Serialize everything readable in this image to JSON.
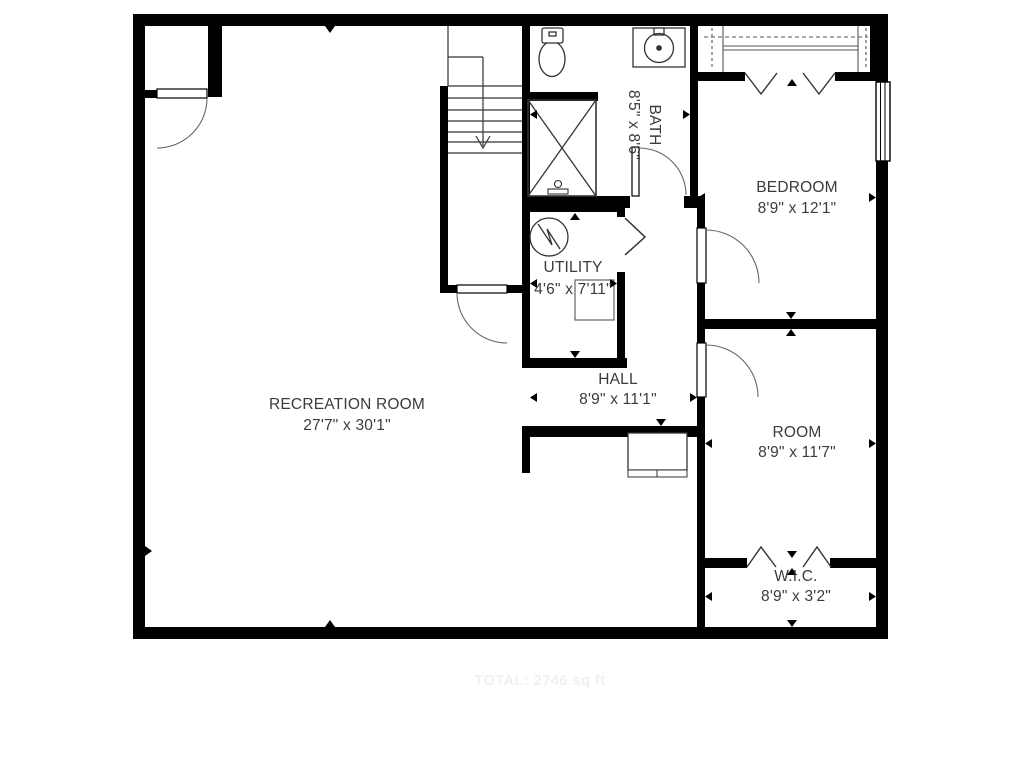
{
  "title": "Basement floor plan",
  "rooms": {
    "recreation": {
      "name": "RECREATION ROOM",
      "dims": "27'7\" x 30'1\""
    },
    "bath": {
      "name": "BATH",
      "dims": "8'5\" x 8'6\""
    },
    "bedroom": {
      "name": "BEDROOM",
      "dims": "8'9\" x 12'1\""
    },
    "utility": {
      "name": "UTILITY",
      "dims": "4'6\" x 7'11\""
    },
    "hall": {
      "name": "HALL",
      "dims": "8'9\" x 11'1\""
    },
    "room": {
      "name": "ROOM",
      "dims": "8'9\" x 11'7\""
    },
    "wic": {
      "name": "W.I.C.",
      "dims": "8'9\" x 3'2\""
    }
  },
  "footer": {
    "watermark": "TOTAL: 2746 sq ft"
  },
  "stairs": {
    "direction": "down"
  },
  "colors": {
    "wall": "#000000",
    "line": "#333333",
    "door_arc": "#666666",
    "text": "#3b3b3b",
    "watermark": "#f0f0f0",
    "background": "#ffffff"
  }
}
